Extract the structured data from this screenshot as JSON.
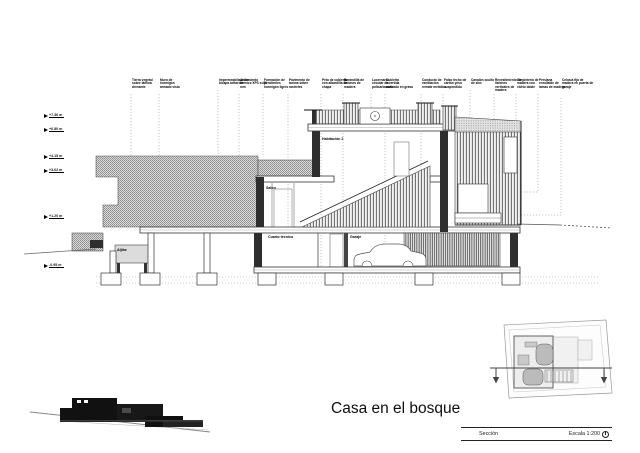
{
  "title": "Casa en el bosque",
  "title_block": {
    "section_label": "Sección",
    "scale_label": "Escala 1:200"
  },
  "levels": [
    "+7.36 m",
    "+6.80 m",
    "+4.15 m",
    "+3.62 m",
    "+1.20 m",
    "-0.95 m"
  ],
  "annotations": [
    "Tierra vegetal sobre lámina drenante",
    "Muro de hormigón armado visto",
    "Impermeabilización bicapa adherida",
    "Aislamiento térmico XPS e=80 mm",
    "Formación de pendientes hormigón ligero",
    "Pavimento de tarima sobre rastreles",
    "Peto de cubierta con albardilla de chapa",
    "Barandilla de listones de madera",
    "Lucernario circular de policarbonato",
    "Cubierta invertida acabado en grava",
    "Conducto de ventilación remate metálico",
    "Falso techo de cartón yeso suspendido",
    "Canalón oculto de zinc",
    "Revestimiento de listones verticales de madera",
    "Carpintería de madera con vidrio doble",
    "Persiana enrollable de lamas de madera",
    "Celosía fija de madera en puerta de garaje"
  ],
  "rooms": {
    "bedroom": "Habitación 2",
    "living": "Salón",
    "utility": "Cuarto técnico",
    "garage": "Garaje",
    "tank": "Aljibe"
  },
  "colors": {
    "line": "#222222",
    "hatch": "#8f8f8f",
    "terrain_fill": "#d9d9d9",
    "silhouette": "#111111"
  }
}
